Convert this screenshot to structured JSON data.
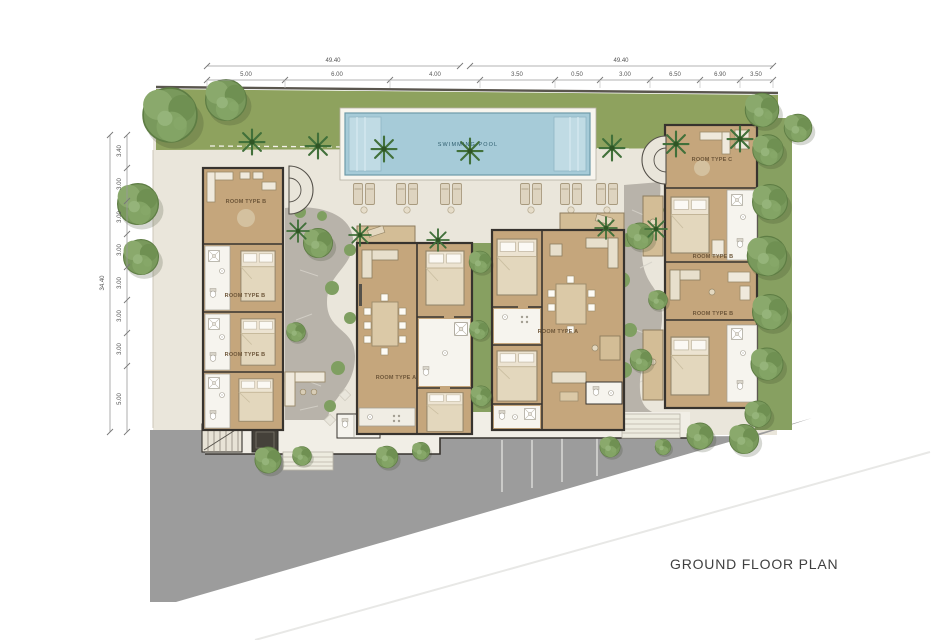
{
  "title": "GROUND FLOOR PLAN",
  "pool": {
    "label": "SWIMMING POOL"
  },
  "room_labels": {
    "left_1": "ROOM TYPE B",
    "left_2": "ROOM TYPE B",
    "left_3": "ROOM TYPE B",
    "mid_left": "ROOM TYPE A",
    "mid_right": "ROOM TYPE A",
    "right_1": "ROOM TYPE C",
    "right_2": "ROOM TYPE B",
    "right_3": "ROOM TYPE B"
  },
  "dimensions": {
    "top": {
      "totals": [
        "49.40",
        "49.40"
      ],
      "segments": [
        "5.00",
        "6.00",
        "4.00",
        "3.50",
        "0.50",
        "3.00",
        "6.50",
        "6.90",
        "3.50"
      ]
    },
    "left": {
      "total": "34.40",
      "segments": [
        "3.40",
        "3.00",
        "3.00",
        "3.00",
        "3.00",
        "3.00",
        "3.00",
        "5.00"
      ]
    }
  },
  "colors": {
    "lawn": "#8ea25e",
    "pool_water": "#a6cbd8",
    "road": "#9c9c9c",
    "building_floor": "#c5a67c",
    "walls": "#37332e",
    "paving": "#eae6db"
  }
}
